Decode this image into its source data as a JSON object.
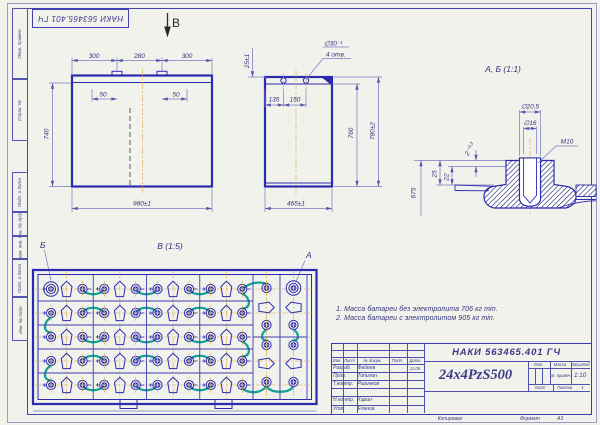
{
  "colors": {
    "paper": "#f2f2ec",
    "line_blue": "#2b2bb0",
    "frame_blue": "#4040b0",
    "dim_text": "#32327e",
    "connector_teal": "#18a295",
    "centerline_tan": "#d8a84e",
    "terminal_fill": "#2e2ea6"
  },
  "stamp": {
    "doc_number": "НАКИ 563465.401 ГЧ"
  },
  "margin_labels": {
    "cell1": "Перв. примен.",
    "cell2": "Справ. №",
    "cell3": "Подп. и дата",
    "cell4": "Инв. № дубл.",
    "cell5": "Взам. инв. №",
    "cell6": "Подп. и дата",
    "cell7": "Инв. № подл."
  },
  "view_b": {
    "label": "В"
  },
  "front_view": {
    "dim_300_left": "300",
    "dim_280": "280",
    "dim_300_right": "300",
    "dim_50_left": "50",
    "dim_50_right": "50",
    "dim_740": "740",
    "dim_980": "980±1"
  },
  "side_view": {
    "callout_line1": "∅30⁻¹",
    "callout_line2": "4 отв.",
    "dim_25": "25±1",
    "dim_135": "135",
    "dim_150": "150",
    "dim_760": "760",
    "dim_780": "780±2",
    "dim_465": "465±1"
  },
  "detail_view": {
    "title": "А, Б (1:1)",
    "dim_d205": "∅20,5",
    "dim_d16": "∅16",
    "dim_m10": "М10",
    "dim_2": "2⁻⁰·²",
    "dim_25": "25",
    "dim_22": "22",
    "dim_675": "675"
  },
  "plan_view": {
    "title": "В (1:5)",
    "label_a": "А",
    "label_b": "Б",
    "grid": {
      "rows": 5,
      "cols": 4,
      "right_cols": 2
    }
  },
  "notes": {
    "line1": "1. Масса батареи без электролита 706 кг min.",
    "line2": "2. Масса батареи с электролитом 905 кг min."
  },
  "title_block": {
    "doc_number": "НАКИ 563465.401 ГЧ",
    "part_name": "24x4PzS500",
    "header_izm": "Изм.",
    "header_list": "Лист",
    "header_docum": "№ докум.",
    "header_podp": "Подп.",
    "header_data": "Дата",
    "rows": [
      {
        "role": "Разраб.",
        "name": "Фадеев",
        "date": "11.09"
      },
      {
        "role": "Пров.",
        "name": "Топилин",
        "date": ""
      },
      {
        "role": "Т.контр.",
        "name": "Разинков",
        "date": ""
      },
      {
        "role": "",
        "name": "",
        "date": ""
      },
      {
        "role": "Н.контр.",
        "name": "Харин",
        "date": ""
      },
      {
        "role": "Утв.",
        "name": "Епанов",
        "date": ""
      }
    ],
    "lit_label": "Лит.",
    "mass_label": "Масса",
    "scale_label": "Масштаб",
    "mass_value": "См. примеч.",
    "scale_value": "1:10",
    "sheet_label": "Лист",
    "sheets_label": "Листов",
    "sheets_value": "1",
    "kopiroval": "Копировал",
    "format_label": "Формат",
    "format_value": "А3"
  }
}
